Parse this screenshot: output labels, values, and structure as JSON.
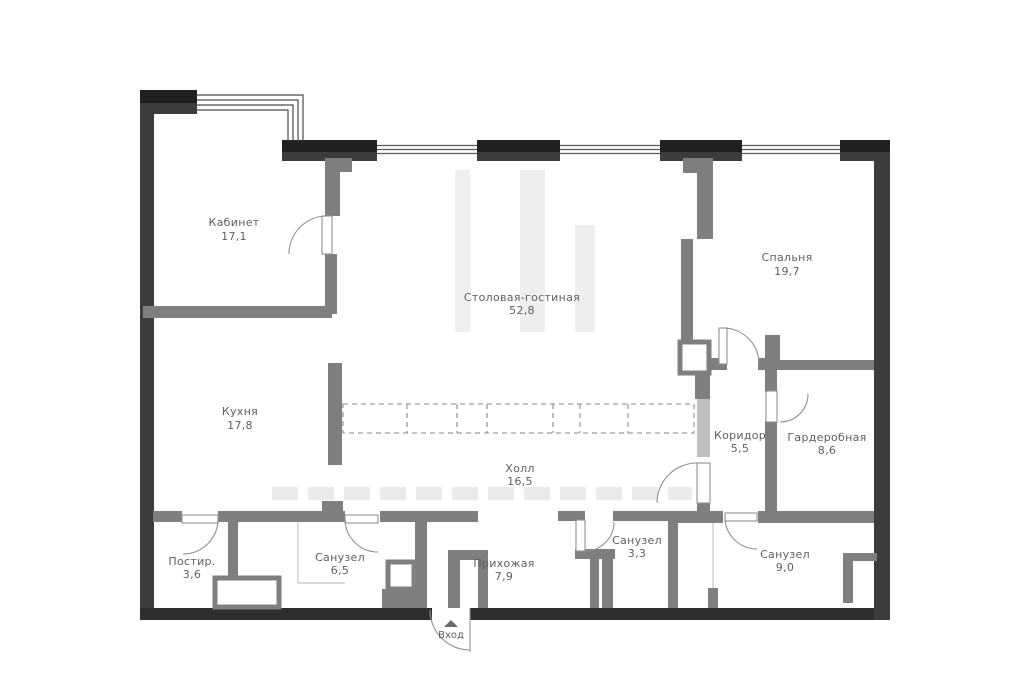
{
  "plan": {
    "title": "apartment-floor-plan",
    "entrance": {
      "label": "Вход"
    },
    "rooms": [
      {
        "id": "kabinet",
        "name": "Кабинет",
        "area": "17,1"
      },
      {
        "id": "stolovaya",
        "name": "Столовая-гостиная",
        "area": "52,8"
      },
      {
        "id": "spalnya",
        "name": "Спальня",
        "area": "19,7"
      },
      {
        "id": "kuhnya",
        "name": "Кухня",
        "area": "17,8"
      },
      {
        "id": "holl",
        "name": "Холл",
        "area": "16,5"
      },
      {
        "id": "koridor",
        "name": "Коридор",
        "area": "5,5"
      },
      {
        "id": "garderobnaya",
        "name": "Гардеробная",
        "area": "8,6"
      },
      {
        "id": "postir",
        "name": "Постир.",
        "area": "3,6"
      },
      {
        "id": "sanuzel-1",
        "name": "Санузел",
        "area": "6,5"
      },
      {
        "id": "prihozhaya",
        "name": "Прихожая",
        "area": "7,9"
      },
      {
        "id": "sanuzel-2",
        "name": "Санузел",
        "area": "3,3"
      },
      {
        "id": "sanuzel-3",
        "name": "Санузел",
        "area": "9,0"
      }
    ],
    "colors": {
      "outer_wall": "#3c3c3c",
      "pier_black": "#202020",
      "interior_wall": "#7f7f7f",
      "label_text": "#5f5f5f",
      "background": "#ffffff"
    }
  }
}
